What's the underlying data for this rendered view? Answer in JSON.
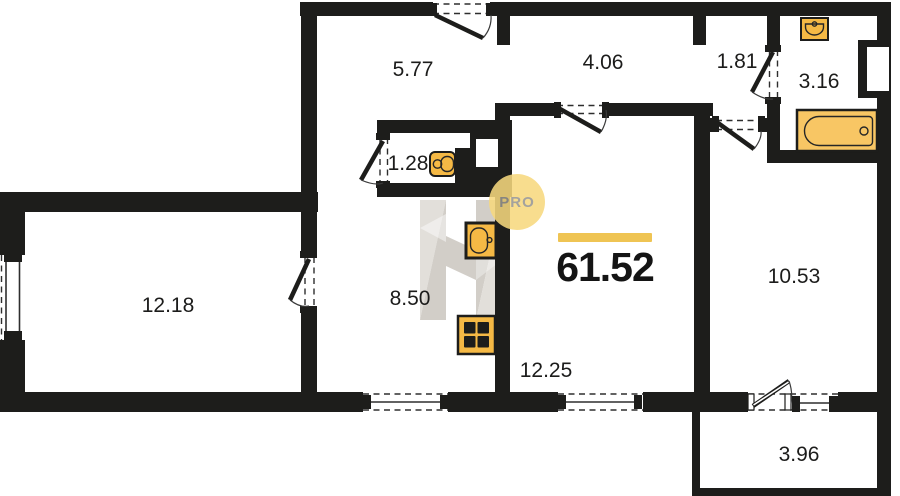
{
  "plan": {
    "total_area": "61.52",
    "rooms": [
      {
        "name": "hallway",
        "area": "5.77"
      },
      {
        "name": "corridor",
        "area": "4.06"
      },
      {
        "name": "passage",
        "area": "1.81"
      },
      {
        "name": "bathroom",
        "area": "3.16"
      },
      {
        "name": "water-closet",
        "area": "1.28"
      },
      {
        "name": "room-left",
        "area": "12.18"
      },
      {
        "name": "kitchen",
        "area": "8.50"
      },
      {
        "name": "room-center",
        "area": "12.25"
      },
      {
        "name": "room-right",
        "area": "10.53"
      },
      {
        "name": "balcony",
        "area": "3.96"
      }
    ],
    "fixtures": [
      "toilet",
      "kitchen-sink",
      "stove",
      "bath-sink",
      "bathtub"
    ],
    "watermark": {
      "text": "PRO"
    },
    "colors": {
      "wall": "#1d1d1b",
      "accent": "#efc453",
      "fixture": "#f5b945",
      "bathtub": "#f8c664",
      "pro_circle": "#f7d97e",
      "logo_light": "#e2dfda",
      "logo_mid": "#d2cec8"
    }
  }
}
